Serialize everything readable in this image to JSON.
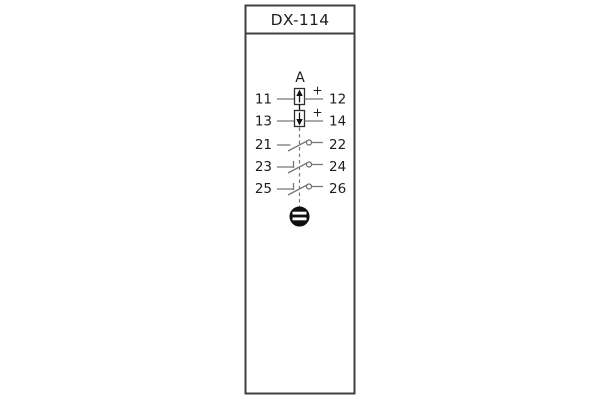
{
  "relay": {
    "title": "DX-114",
    "group_label": "A",
    "polarity_marks": [
      "+",
      "+"
    ],
    "terminal_rows": [
      {
        "left": "11",
        "right": "12",
        "element": "up-arrow-measuring-element-icon"
      },
      {
        "left": "13",
        "right": "14",
        "element": "down-arrow-measuring-element-icon"
      },
      {
        "left": "21",
        "right": "22",
        "element": "normally-open-contact-icon"
      },
      {
        "left": "23",
        "right": "24",
        "element": "normally-open-contact-icon"
      },
      {
        "left": "25",
        "right": "26",
        "element": "normally-open-contact-icon"
      }
    ],
    "bottom_icon": "screw-terminal-icon",
    "colors": {
      "background": "#ffffff",
      "outline": "#3f3f3f",
      "wire": "#787878",
      "ink": "#1d1d1d"
    }
  }
}
